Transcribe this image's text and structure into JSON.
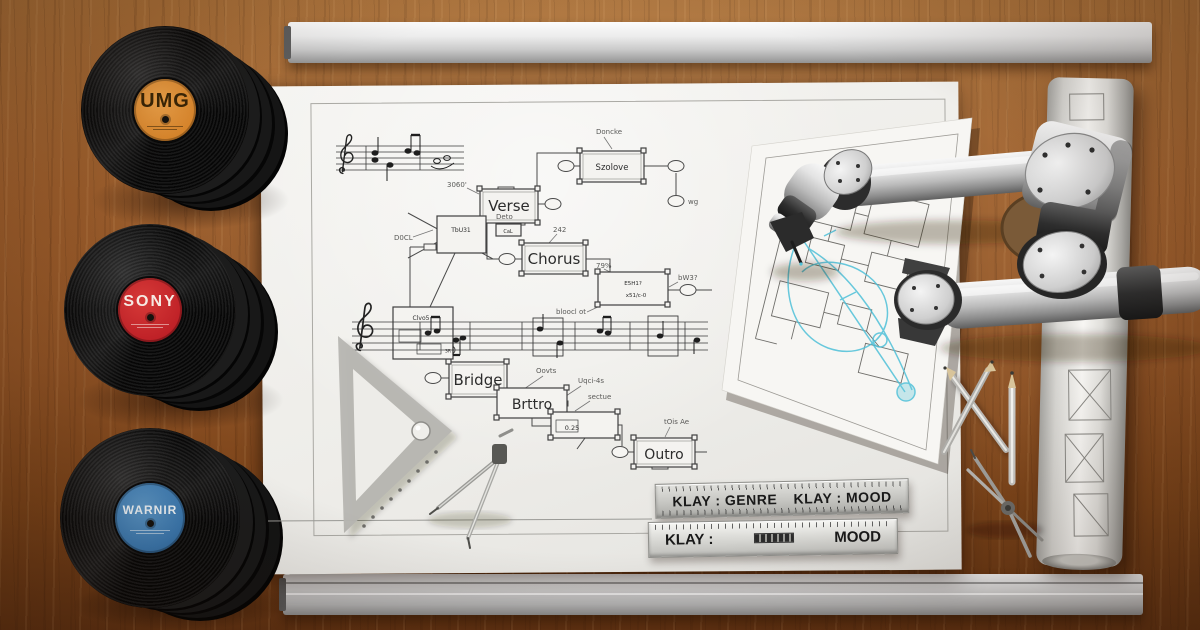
{
  "scene": {
    "description": "Robotic arm drafting a song-structure blueprint on a wooden desk with record-label vinyl stacks",
    "colors": {
      "wood": "#8f5527",
      "paper": "#efeeeb",
      "sketch_cyan": "#4fc0d8",
      "umg_label": "#d9862c",
      "sony_label": "#bf2127",
      "warner_label": "#3b79b1",
      "metal": "#c9c9c9"
    }
  },
  "records": [
    {
      "name": "UMG"
    },
    {
      "name": "SONY"
    },
    {
      "name": "WARNIR"
    }
  ],
  "diagram": {
    "boxes": {
      "top": "Szolove",
      "verse": "Verse",
      "chorus": "Chorus",
      "bridge": "Bridge",
      "intro": "Brttro",
      "outro": "Outro",
      "aux1": "TbU31",
      "aux2": "Clvo5",
      "aux3": "E5H1?",
      "aux3b": "x51/c-0",
      "aux4": "0.25"
    },
    "annotations": {
      "a1": "Doncke",
      "a2": "3060'",
      "a3": "Deto",
      "a4": "242",
      "a5": "79%",
      "a6": "wg",
      "a7": "D0CL",
      "a8": "Oovts",
      "a9": "Uqci-4s",
      "a10": "sectue",
      "a11": "tOis Ae",
      "a12": "bloocl ot",
      "a13": "bW3?",
      "a14": "CaL",
      "a15": "3R"
    }
  },
  "rulers": {
    "ruler1": {
      "left": "KLAY : GENRE",
      "right": "KLAY : MOOD"
    },
    "ruler2": {
      "left": "KLAY :",
      "right": "MOOD"
    }
  }
}
